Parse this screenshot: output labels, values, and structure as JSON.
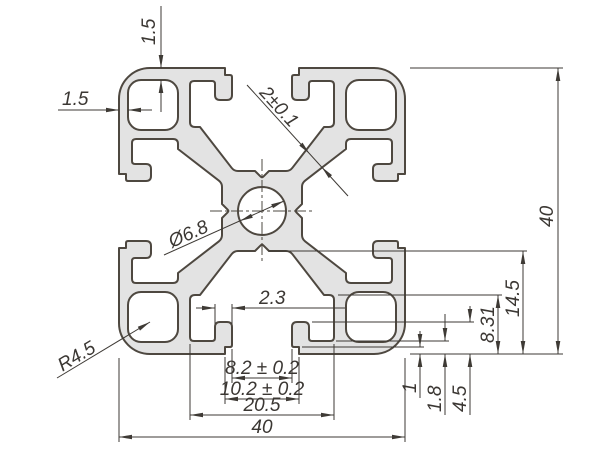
{
  "drawing": {
    "dims": {
      "wall_top": "1.5",
      "wall_left": "1.5",
      "web_thickness": "2±0.1",
      "center_bore": "Ø6.8",
      "corner_radius": "R4.5",
      "lip_width": "2.3",
      "slot_opening": "8.2 ± 0.2",
      "slot_mouth": "10.2 ± 0.2",
      "slot_inner_width": "20.5",
      "overall_width": "40",
      "overall_height": "40",
      "slot_depth": "14.5",
      "slot_wing_depth": "8.31",
      "lip_height": "4.5",
      "lip_root": "1.8",
      "face_notch": "1"
    },
    "colors": {
      "background": "#ffffff",
      "profile_fill": "#e3e3e3",
      "outline": "#4e4840",
      "dimension": "#3e3a35"
    }
  }
}
